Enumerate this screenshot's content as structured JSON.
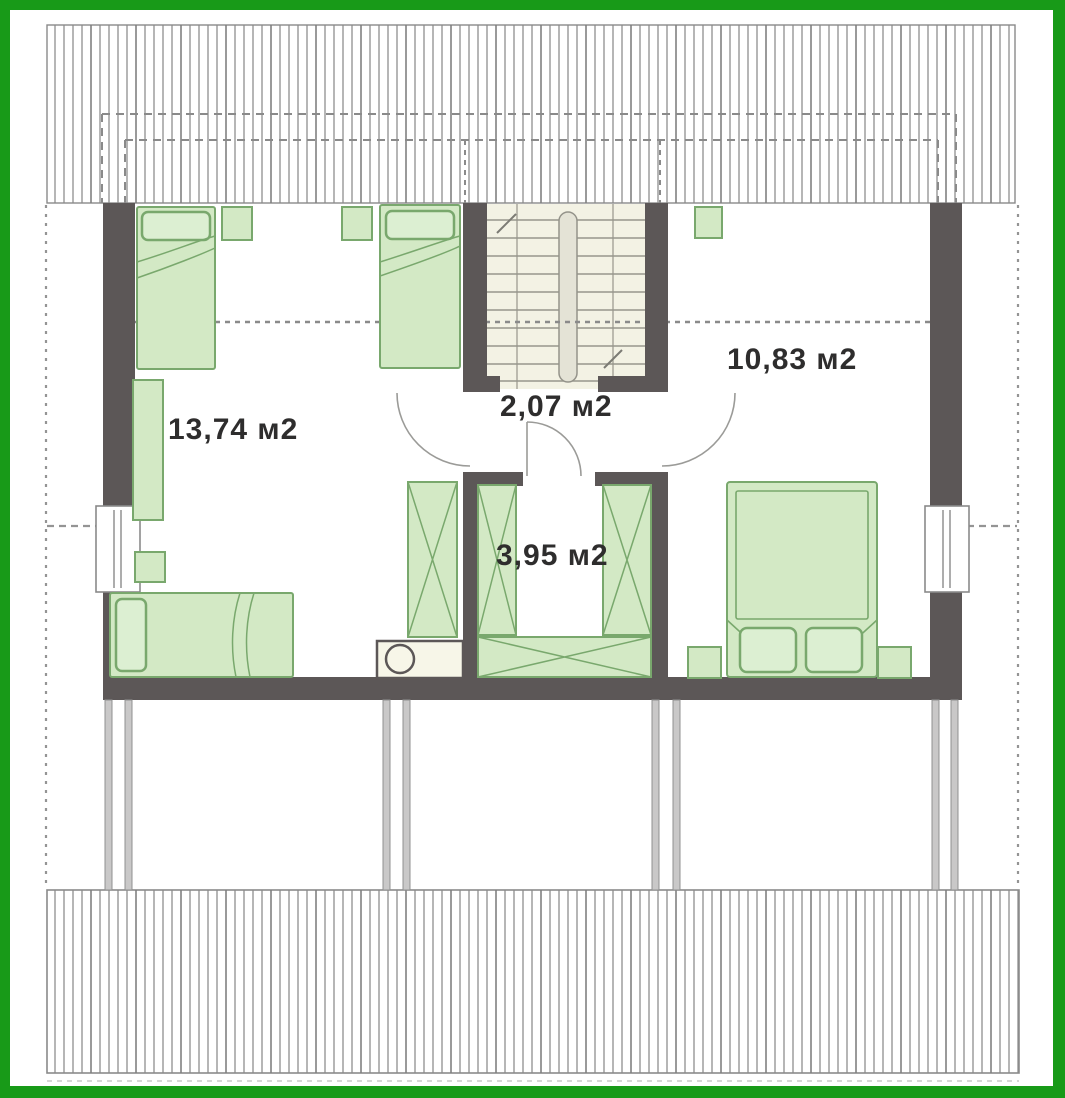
{
  "meta": {
    "title": "Attic floor plan",
    "drawing_type": "floor-plan"
  },
  "rooms": [
    {
      "id": "bedroom-left",
      "area_label": "13,74 м2"
    },
    {
      "id": "hallway",
      "area_label": "2,07 м2"
    },
    {
      "id": "bedroom-right",
      "area_label": "10,83 м2"
    },
    {
      "id": "wardrobe-room",
      "area_label": "3,95 м2"
    }
  ],
  "symbols": [
    "roof-hatch",
    "wall",
    "window",
    "door-arc",
    "staircase",
    "single-bed",
    "double-bed",
    "nightstand",
    "wardrobe-x",
    "washing-machine",
    "post"
  ],
  "palette": {
    "frame_green": "#189a18",
    "wall_gray": "#5c5757",
    "furniture_fill": "#d3e9c5",
    "furniture_stroke": "#79a86d",
    "pillow_fill": "#dcefd2",
    "stair_fill": "#f3f2e4",
    "hatch_line": "#8f8f8f",
    "dash_gray": "#8a8a8a",
    "label_color": "#2e2d2d"
  }
}
